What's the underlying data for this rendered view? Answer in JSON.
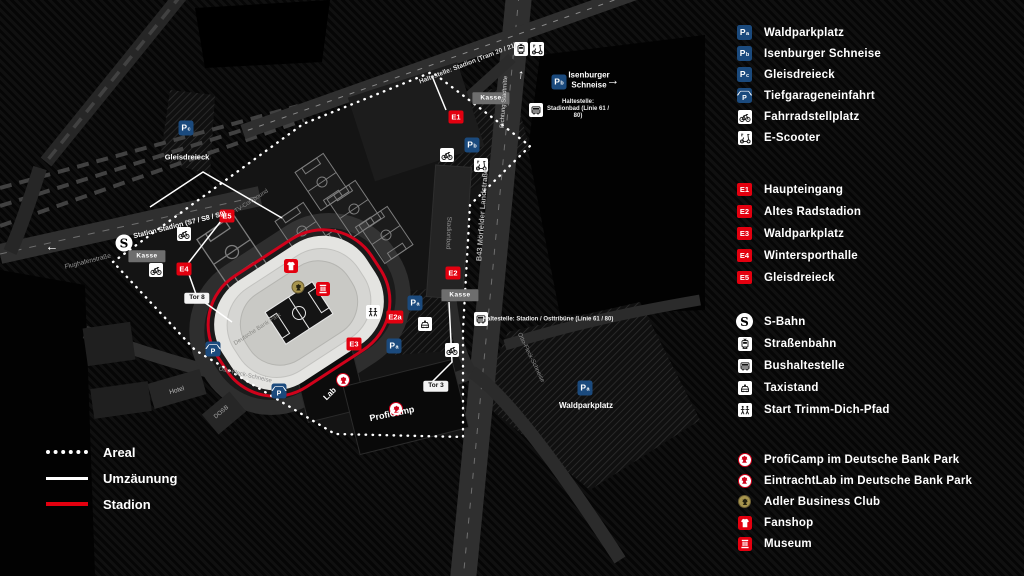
{
  "colors": {
    "red": "#e3000f",
    "blue": "#1b4a7d",
    "gold": "#a8954e",
    "stadium_line": "#d0021b"
  },
  "legend": {
    "parking": [
      {
        "id": "Pa",
        "icon": "p-square",
        "label": "Waldparkplatz"
      },
      {
        "id": "Pb",
        "icon": "p-square",
        "label": "Isenburger Schneise"
      },
      {
        "id": "Pc",
        "icon": "p-square",
        "label": "Gleisdreieck"
      },
      {
        "id": "P",
        "icon": "garage",
        "label": "Tiefgarageneinfahrt"
      },
      {
        "icon": "bicycle",
        "label": "Fahrradstellplatz"
      },
      {
        "icon": "scooter",
        "label": "E-Scooter"
      }
    ],
    "entrances": [
      {
        "id": "E1",
        "label": "Haupteingang"
      },
      {
        "id": "E2",
        "label": "Altes Radstadion"
      },
      {
        "id": "E3",
        "label": "Waldparkplatz"
      },
      {
        "id": "E4",
        "label": "Wintersporthalle"
      },
      {
        "id": "E5",
        "label": "Gleisdreieck"
      }
    ],
    "transit": [
      {
        "icon": "sbahn",
        "label": "S-Bahn"
      },
      {
        "icon": "tram",
        "label": "Straßenbahn"
      },
      {
        "icon": "bus",
        "label": "Bushaltestelle"
      },
      {
        "icon": "taxi",
        "label": "Taxistand"
      },
      {
        "icon": "trimm",
        "label": "Start Trimm-Dich-Pfad"
      }
    ],
    "club": [
      {
        "icon": "crest",
        "label": "ProfiCamp im Deutsche Bank Park"
      },
      {
        "icon": "crest",
        "label": "EintrachtLab im Deutsche Bank Park"
      },
      {
        "icon": "adler",
        "label": "Adler Business Club"
      },
      {
        "icon": "fanshop",
        "label": "Fanshop"
      },
      {
        "icon": "museum",
        "label": "Museum"
      }
    ],
    "lines": [
      {
        "style": "dotted",
        "label": "Areal"
      },
      {
        "style": "solid",
        "label": "Umzäunung"
      },
      {
        "style": "red",
        "label": "Stadion"
      }
    ]
  },
  "map": {
    "markers": [
      {
        "type": "p",
        "id": "Pc",
        "name": "parking-marker-pc-gleisdreieck",
        "x": 186,
        "y": 128
      },
      {
        "type": "p",
        "id": "Pb",
        "name": "parking-marker-pb-isenburger",
        "x": 559,
        "y": 82
      },
      {
        "type": "p",
        "id": "Pb",
        "name": "parking-marker-pb-north",
        "x": 472,
        "y": 145
      },
      {
        "type": "p",
        "id": "Pa",
        "name": "parking-marker-pa-east",
        "x": 415,
        "y": 303
      },
      {
        "type": "p",
        "id": "Pa",
        "name": "parking-marker-pa-south",
        "x": 394,
        "y": 346
      },
      {
        "type": "p",
        "id": "Pa",
        "name": "parking-marker-pa-waldparkplatz",
        "x": 585,
        "y": 388
      },
      {
        "type": "garage",
        "id": "P",
        "name": "tiefgarage-marker-west",
        "x": 213,
        "y": 349
      },
      {
        "type": "garage",
        "id": "P",
        "name": "tiefgarage-marker-south",
        "x": 279,
        "y": 391
      },
      {
        "type": "e",
        "id": "E1",
        "name": "entrance-marker-e1",
        "x": 456,
        "y": 117
      },
      {
        "type": "e",
        "id": "E2",
        "name": "entrance-marker-e2",
        "x": 453,
        "y": 273
      },
      {
        "type": "e",
        "id": "E2a",
        "name": "entrance-marker-e2a",
        "x": 395,
        "y": 317
      },
      {
        "type": "e",
        "id": "E3",
        "name": "entrance-marker-e3",
        "x": 354,
        "y": 344
      },
      {
        "type": "e",
        "id": "E4",
        "name": "entrance-marker-e4",
        "x": 184,
        "y": 269
      },
      {
        "type": "e",
        "id": "E5",
        "name": "entrance-marker-e5",
        "x": 227,
        "y": 216
      },
      {
        "type": "icon",
        "icon": "tram",
        "name": "tram-stop-icon",
        "x": 521,
        "y": 49
      },
      {
        "type": "icon",
        "icon": "scooter",
        "name": "scooter-icon-north",
        "x": 537,
        "y": 49
      },
      {
        "type": "icon",
        "icon": "bicycle",
        "name": "bicycle-icon-north",
        "x": 447,
        "y": 155
      },
      {
        "type": "icon",
        "icon": "scooter",
        "name": "scooter-icon-lot",
        "x": 481,
        "y": 165
      },
      {
        "type": "icon",
        "icon": "bicycle",
        "name": "bicycle-icon-west-1",
        "x": 184,
        "y": 234
      },
      {
        "type": "icon",
        "icon": "bicycle",
        "name": "bicycle-icon-west-2",
        "x": 156,
        "y": 270
      },
      {
        "type": "icon",
        "icon": "bicycle",
        "name": "bicycle-icon-tor3",
        "x": 452,
        "y": 350
      },
      {
        "type": "icon",
        "icon": "bus",
        "name": "bus-stop-icon-stadionbad",
        "x": 536,
        "y": 110
      },
      {
        "type": "icon",
        "icon": "bus",
        "name": "bus-stop-icon-osttribuene",
        "x": 481,
        "y": 319
      },
      {
        "type": "icon",
        "icon": "taxi",
        "name": "taxi-stand-icon",
        "x": 425,
        "y": 324
      },
      {
        "type": "icon",
        "icon": "trimm",
        "name": "trimm-dich-pfad-start-icon",
        "x": 373,
        "y": 312
      },
      {
        "type": "sbahn",
        "id": "S",
        "name": "sbahn-logo",
        "x": 124,
        "y": 243
      },
      {
        "type": "fanshop",
        "name": "fanshop-icon-map",
        "x": 291,
        "y": 266
      },
      {
        "type": "adler",
        "name": "adler-business-club-icon-map",
        "x": 298,
        "y": 287
      },
      {
        "type": "museum",
        "name": "museum-icon-map",
        "x": 323,
        "y": 289
      },
      {
        "type": "crest",
        "name": "eintrachtlab-crest-icon",
        "x": 343,
        "y": 380
      },
      {
        "type": "crest",
        "name": "proficamp-crest-icon",
        "x": 396,
        "y": 409
      },
      {
        "type": "box",
        "text": "Kasse",
        "name": "kasse-box-west",
        "x": 147,
        "y": 256
      },
      {
        "type": "box",
        "text": "Kasse",
        "name": "kasse-box-north",
        "x": 491,
        "y": 98
      },
      {
        "type": "box",
        "text": "Kasse",
        "name": "kasse-box-east",
        "x": 460,
        "y": 295
      },
      {
        "type": "tor",
        "text": "Tor 8",
        "name": "gate-label-tor8",
        "x": 197,
        "y": 298
      },
      {
        "type": "tor",
        "text": "Tor 3",
        "name": "gate-label-tor3",
        "x": 436,
        "y": 386
      },
      {
        "type": "arrow",
        "text": "←",
        "name": "arrow-west-sbahn",
        "x": 52,
        "y": 246,
        "rot": 0
      },
      {
        "type": "arrow",
        "text": "→",
        "name": "arrow-east-isenburger",
        "x": 613,
        "y": 80,
        "rot": 0
      },
      {
        "type": "arrow",
        "text": "↑",
        "name": "arrow-north-b43",
        "x": 521,
        "y": 74,
        "rot": 5
      }
    ],
    "labels": [
      {
        "name": "label-tram-stop",
        "text": "Haltestelle: Stadion (Tram 20 / 21)",
        "x": 468,
        "y": 64,
        "rot": -21,
        "fs": 6.5,
        "color": "#dddddd",
        "bold": true
      },
      {
        "name": "label-isenburger-schneise",
        "text": "Isenburger Schneise",
        "x": 589,
        "y": 80,
        "rot": 0,
        "fs": 8,
        "color": "#ffffff",
        "bold": true,
        "w": 48
      },
      {
        "name": "label-stop-stadionbad",
        "text": "Haltestelle: Stadionbad (Linie 61 / 80)",
        "x": 578,
        "y": 110,
        "rot": 0,
        "fs": 6,
        "color": "#eeeeee",
        "bold": true,
        "w": 64
      },
      {
        "name": "label-stop-osttribuene",
        "text": "Haltestelle: Stadion / Osttribüne (Linie 61 / 80)",
        "x": 548,
        "y": 320,
        "rot": 0,
        "fs": 6,
        "color": "#eeeeee",
        "bold": true
      },
      {
        "name": "label-sbahn-station",
        "text": "Station Stadion (S7 / S8 / S9)",
        "x": 180,
        "y": 226,
        "rot": -14,
        "fs": 7,
        "color": "#ffffff",
        "bold": true
      },
      {
        "name": "label-flughafenstrasse",
        "text": "Flughafenstraße",
        "x": 88,
        "y": 262,
        "rot": -14,
        "fs": 6.5,
        "color": "#999999"
      },
      {
        "name": "label-b43",
        "text": "B43   Mörfelder Landstraße",
        "x": 482,
        "y": 215,
        "rot": -86,
        "fs": 7.5,
        "color": "#b5b5b5",
        "bold": true
      },
      {
        "name": "label-richtung-stadtmitte",
        "text": "Richtung Stadtmitte",
        "x": 505,
        "y": 102,
        "rot": -86,
        "fs": 6,
        "color": "#dddddd"
      },
      {
        "name": "label-otto-fleck-1",
        "text": "Otto-Fleck-Schneise",
        "x": 245,
        "y": 376,
        "rot": 13,
        "fs": 6,
        "color": "#8f8f8f"
      },
      {
        "name": "label-otto-fleck-2",
        "text": "Otto-Fleck-Schneise",
        "x": 530,
        "y": 358,
        "rot": 64,
        "fs": 6,
        "color": "#8f8f8f"
      },
      {
        "name": "label-tv-compound",
        "text": "TV-Compound",
        "x": 252,
        "y": 202,
        "rot": -33,
        "fs": 6,
        "color": "#8f8f8f"
      },
      {
        "name": "label-stadionbad-building",
        "text": "Stadionbad",
        "x": 448,
        "y": 233,
        "rot": 92,
        "fs": 6.5,
        "color": "#8f8f8f"
      },
      {
        "name": "label-gleisdreieck",
        "text": "Gleisdreieck",
        "x": 187,
        "y": 157,
        "rot": 0,
        "fs": 7.5,
        "color": "#ffffff",
        "bold": true
      },
      {
        "name": "label-waldparkplatz",
        "text": "Waldparkplatz",
        "x": 586,
        "y": 406,
        "rot": 0,
        "fs": 8,
        "color": "#ffffff",
        "bold": true
      },
      {
        "name": "label-stadium-name",
        "text": "Deutsche Bank Park",
        "x": 258,
        "y": 330,
        "rot": -33,
        "fs": 6,
        "color": "#8a8a86"
      },
      {
        "name": "label-lab",
        "text": "Lab",
        "x": 330,
        "y": 394,
        "rot": -45,
        "fs": 8,
        "color": "#ffffff",
        "bold": true
      },
      {
        "name": "label-proficamp",
        "text": "ProfiCamp",
        "x": 392,
        "y": 414,
        "rot": -12,
        "fs": 9,
        "color": "#ffffff",
        "bold": true
      },
      {
        "name": "label-hotel",
        "text": "Hotel",
        "x": 177,
        "y": 391,
        "rot": -16,
        "fs": 6.5,
        "color": "#bbbbbb"
      },
      {
        "name": "label-dosb",
        "text": "DOSB",
        "x": 222,
        "y": 413,
        "rot": -40,
        "fs": 6,
        "color": "#aaaaaa"
      }
    ]
  }
}
